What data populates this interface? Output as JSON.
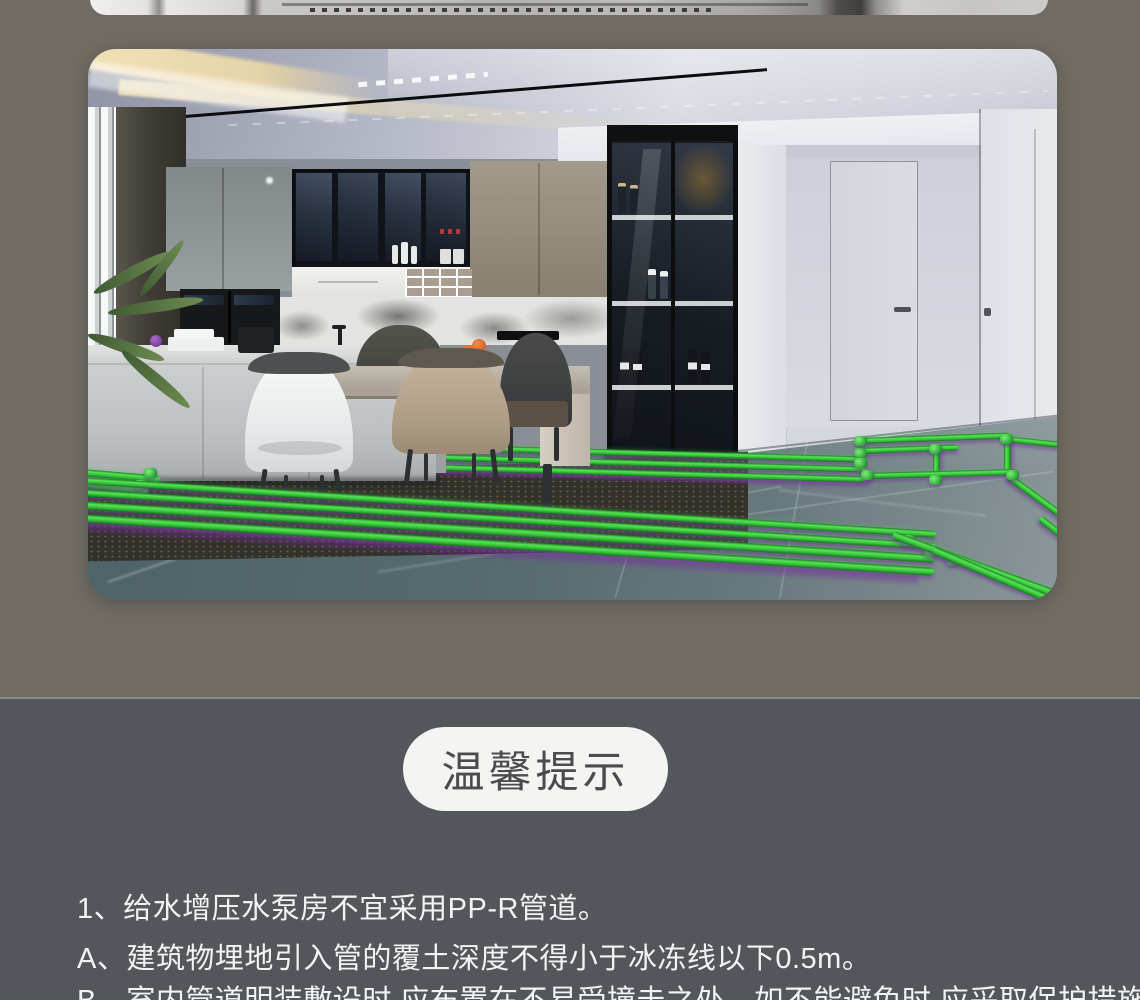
{
  "theme": {
    "page_bg_top": "#706c64",
    "page_bg_bottom": "#53575b",
    "pipe_green": "#3fd344",
    "pipe_shadow_purple": "#7a2f9e",
    "floor_teal": "#5a7276",
    "badge_bg": "#f4f4f2",
    "badge_text_color": "#4b4b4b",
    "note_text_color": "#f2f3f4"
  },
  "tips": {
    "badge_label": "温馨提示",
    "notes": [
      "1、给水增压水泵房不宜采用PP-R管道。",
      "A、建筑物埋地引入管的覆土深度不得小于冰冻线以下0.5m。",
      "B、室内管道明装敷设时,应布置在不易受撞击之处。如不能避免时,应采取保护措施。"
    ]
  }
}
